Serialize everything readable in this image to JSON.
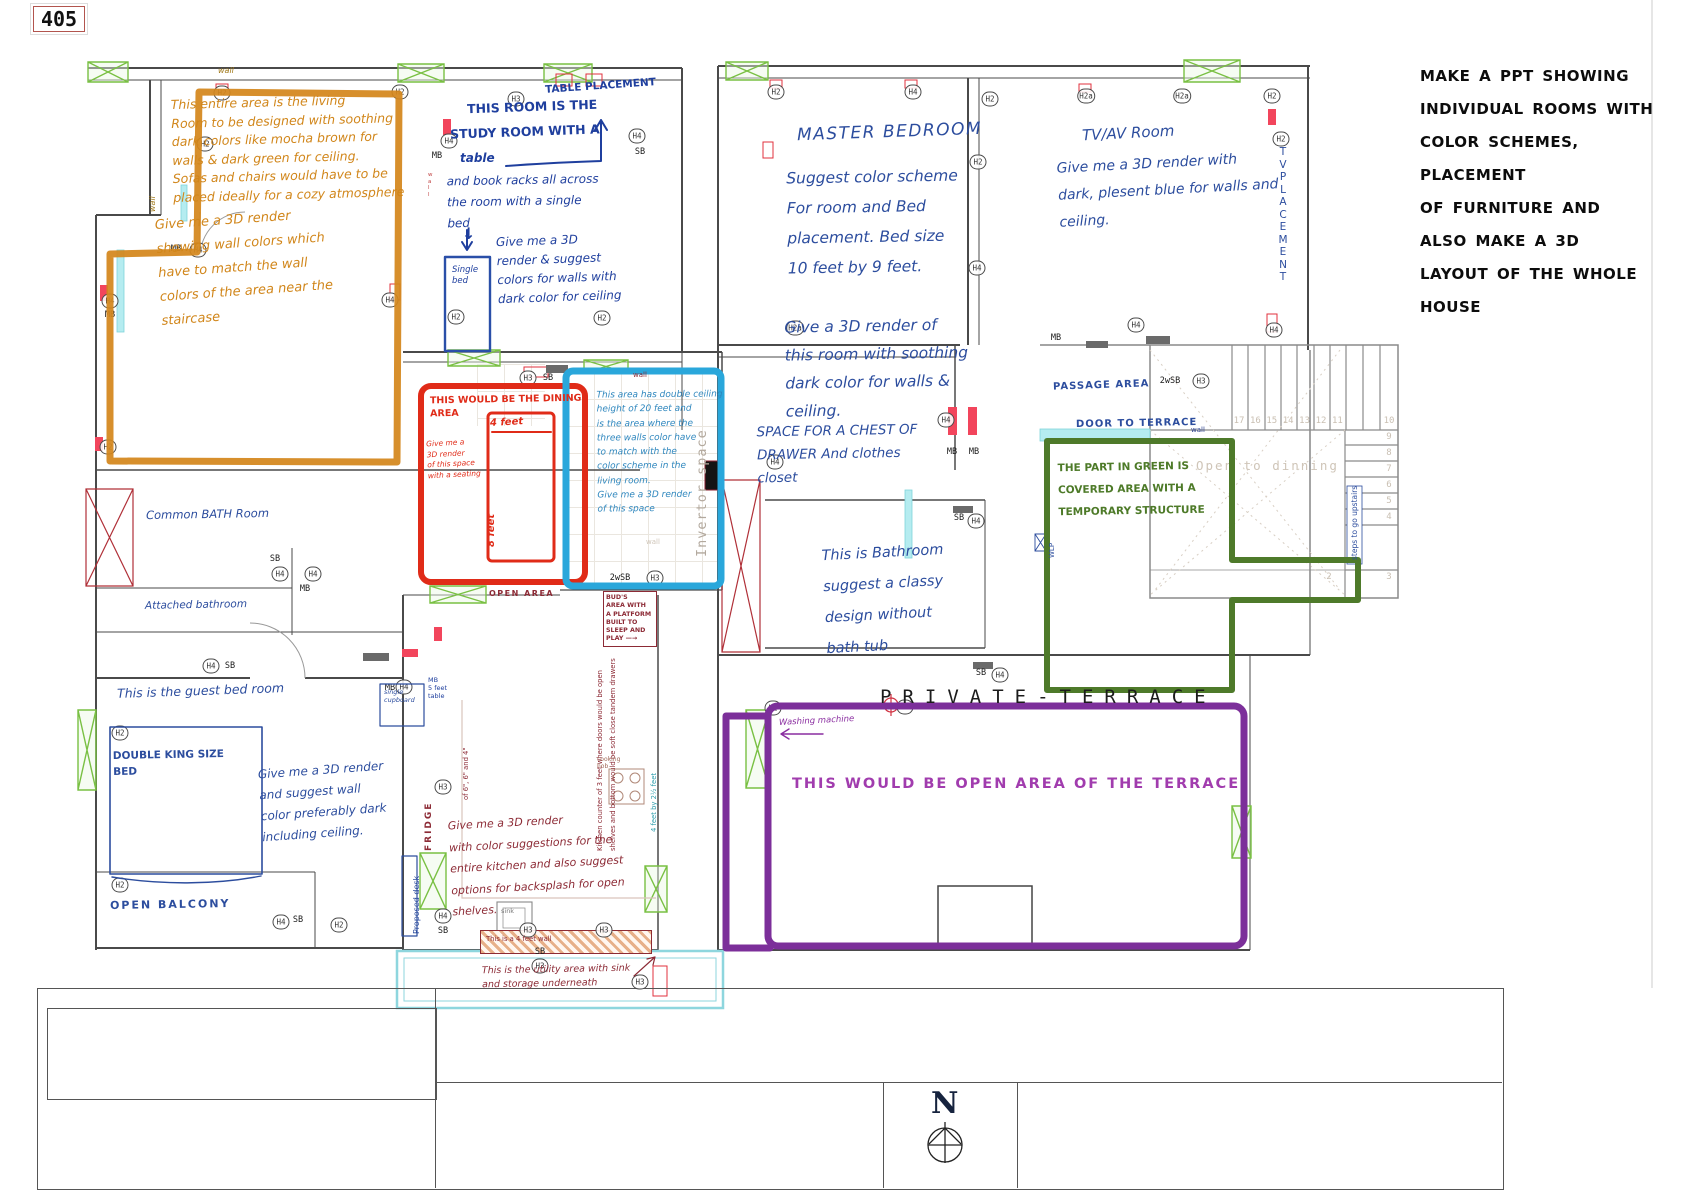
{
  "page": {
    "plan_number": "405",
    "north_label": "N",
    "private_terrace": "PRIVATE-TERRACE"
  },
  "colors": {
    "orange": "#d1861a",
    "blue": "#2c4d9e",
    "red": "#e02b18",
    "cyan": "#2aa7db",
    "green": "#4e7a2a",
    "purple": "#7c2f9a",
    "maroon": "#8c2a35",
    "black": "#0c0c0c"
  },
  "brief": {
    "text": "MAKE A PPT SHOWING\nINDIVIDUAL ROOMS WITH\nCOLOR SCHEMES, PLACEMENT\nOF FURNITURE AND\nALSO MAKE A 3D\nLAYOUT OF THE WHOLE\nHOUSE"
  },
  "living_room": {
    "note": "This entire area is the living\nRoom to be designed with soothing\ndark colors like mocha brown for\nwalls & dark green for ceiling.\nSofas and chairs would have to be\nplaced ideally for a cozy atmosphere",
    "render_note": "Give me a 3D render\nshowing wall colors which\nhave to match the wall\ncolors of the area near the\nstaircase"
  },
  "study_room": {
    "table_placement": "TABLE PLACEMENT",
    "heading1": "THIS ROOM IS THE",
    "heading2": "STUDY ROOM WITH A",
    "heading3": "table",
    "detail": "and book racks all across\nthe room with a single\nbed",
    "arrow_down": "↓",
    "single_bed": "Single\nbed",
    "render_note": "Give me a 3D\nrender & suggest\ncolors for walls with\ndark color for ceiling"
  },
  "dining": {
    "title": "THIS WOULD BE THE DINING\nAREA",
    "render_note": "Give me a\n3D render\nof this space\nwith a seating",
    "width_label": "4 feet",
    "height_label": "8 feet"
  },
  "double_height": {
    "note": "This area has double ceiling\nheight of 20 feet and\nis the area where the\nthree walls color have\nto match with the\ncolor scheme in the\nliving room.\nGive me a 3D render\nof this space",
    "invertor_label": "Invertor space"
  },
  "bath_left": {
    "common": "Common BATH Room",
    "attached": "Attached bathroom",
    "open_area": "OPEN AREA"
  },
  "guest_room": {
    "title": "This is the guest bed room",
    "bed_label": "DOUBLE KING SIZE\nBED",
    "render_note": "Give me a 3D render\nand suggest wall\ncolor preferably dark\nincluding ceiling.",
    "cupboard": "single\ncupboard",
    "side_table": "MB\n5 feet\ntable",
    "desk": "Proposed desk",
    "balcony": "OPEN BALCONY"
  },
  "kitchen": {
    "render_note": "Give me a 3D render\nwith color suggestions for the\nentire kitchen and also suggest\noptions for backsplash for open\nshelves.",
    "buds_note": "BUD'S\nAREA WITH\nA PLATFORM\nBUILT TO\nSLEEP AND\nPLAY —→",
    "counter_note1": "Kitchen counter of 3 feet where doors would be open",
    "counter_note2": "shelves and bottom would be soft close tandem drawers",
    "counter_note3": "of 6\", 6\" and 4\"",
    "counter_dim": "4 feet by 2½ feet",
    "fridge": "FRIDGE",
    "hob": "cooking\nhob",
    "sink": "sink",
    "wall_note": "This is a 4 feet wall",
    "utility_note": "This is the utility area with sink\nand storage underneath"
  },
  "master_bedroom": {
    "title": "MASTER BEDROOM",
    "note1": "Suggest color scheme\nFor room and Bed\nplacement. Bed size\n10 feet by 9 feet.",
    "note2": "Give a 3D render of\nthis room with soothing\ndark color for walls &\nceiling.",
    "note3": "SPACE FOR A CHEST OF\nDRAWER And clothes\ncloset"
  },
  "tv_room": {
    "title": "TV/AV Room",
    "note": "Give me a 3D render with\ndark, plesent blue for walls and\nceiling.",
    "tv_placement": "T\nV\nP\nL\nA\nC\nE\nM\nE\nN\nT"
  },
  "passage": {
    "label": "PASSAGE AREA",
    "door": "DOOR TO TERRACE",
    "wlp": "WLP"
  },
  "covered_area": {
    "note": "THE PART IN GREEN IS\nCOVERED AREA WITH A\nTEMPORARY STRUCTURE"
  },
  "bathroom_right": {
    "note": "This is Bathroom\nsuggest a classy\ndesign without\nbath tub"
  },
  "stairs": {
    "open_label": "Open to dinning",
    "steps_note": "steps to go upstairs",
    "top_numbers": [
      "17",
      "16",
      "15",
      "14",
      "13",
      "12",
      "11"
    ],
    "right_numbers": [
      "10",
      "9",
      "8",
      "7",
      "6",
      "5",
      "4"
    ],
    "bottom_numbers": [
      "2",
      "3"
    ]
  },
  "terrace": {
    "note": "THIS WOULD BE OPEN AREA OF THE TERRACE",
    "washing": "Washing machine"
  },
  "plan_labels": {
    "wall": "wall",
    "wall_vertical": "w\na\nl\nl"
  },
  "markers": [
    {
      "label": "H2",
      "x": 222,
      "y": 93,
      "circled": true
    },
    {
      "label": "H2",
      "x": 400,
      "y": 92,
      "circled": true
    },
    {
      "label": "H3",
      "x": 516,
      "y": 99,
      "circled": true
    },
    {
      "label": "H4",
      "x": 637,
      "y": 136,
      "circled": true
    },
    {
      "label": "SB",
      "x": 640,
      "y": 152,
      "circled": false
    },
    {
      "label": "H4",
      "x": 449,
      "y": 141,
      "circled": true
    },
    {
      "label": "MB",
      "x": 437,
      "y": 156,
      "circled": false
    },
    {
      "label": "H2",
      "x": 205,
      "y": 144,
      "circled": true
    },
    {
      "label": "MB",
      "x": 176,
      "y": 249,
      "circled": false
    },
    {
      "label": "H4",
      "x": 198,
      "y": 250,
      "circled": true
    },
    {
      "label": "H4",
      "x": 110,
      "y": 301,
      "circled": true
    },
    {
      "label": "MB",
      "x": 110,
      "y": 315,
      "circled": false
    },
    {
      "label": "H4",
      "x": 390,
      "y": 300,
      "circled": true
    },
    {
      "label": "H2",
      "x": 456,
      "y": 317,
      "circled": true
    },
    {
      "label": "H2",
      "x": 602,
      "y": 318,
      "circled": true
    },
    {
      "label": "H2",
      "x": 108,
      "y": 447,
      "circled": true
    },
    {
      "label": "H3",
      "x": 528,
      "y": 378,
      "circled": true
    },
    {
      "label": "SB",
      "x": 548,
      "y": 378,
      "circled": false
    },
    {
      "label": "SB",
      "x": 275,
      "y": 559,
      "circled": false
    },
    {
      "label": "H4",
      "x": 280,
      "y": 574,
      "circled": true
    },
    {
      "label": "H4",
      "x": 313,
      "y": 574,
      "circled": true
    },
    {
      "label": "MB",
      "x": 305,
      "y": 589,
      "circled": false
    },
    {
      "label": "2wSB",
      "x": 620,
      "y": 578,
      "circled": false
    },
    {
      "label": "H3",
      "x": 655,
      "y": 578,
      "circled": true
    },
    {
      "label": "H4",
      "x": 211,
      "y": 666,
      "circled": true
    },
    {
      "label": "SB",
      "x": 230,
      "y": 666,
      "circled": false
    },
    {
      "label": "H2",
      "x": 120,
      "y": 733,
      "circled": true
    },
    {
      "label": "H2",
      "x": 120,
      "y": 885,
      "circled": true
    },
    {
      "label": "H4",
      "x": 404,
      "y": 687,
      "circled": true
    },
    {
      "label": "MB",
      "x": 390,
      "y": 688,
      "circled": false
    },
    {
      "label": "H3",
      "x": 443,
      "y": 787,
      "circled": true
    },
    {
      "label": "H4",
      "x": 443,
      "y": 916,
      "circled": true
    },
    {
      "label": "SB",
      "x": 443,
      "y": 931,
      "circled": false
    },
    {
      "label": "SB",
      "x": 540,
      "y": 952,
      "circled": false
    },
    {
      "label": "H3",
      "x": 540,
      "y": 966,
      "circled": true
    },
    {
      "label": "H3",
      "x": 528,
      "y": 930,
      "circled": true
    },
    {
      "label": "H3",
      "x": 604,
      "y": 930,
      "circled": true
    },
    {
      "label": "H3",
      "x": 640,
      "y": 982,
      "circled": true
    },
    {
      "label": "H4",
      "x": 281,
      "y": 922,
      "circled": true
    },
    {
      "label": "SB",
      "x": 298,
      "y": 920,
      "circled": false
    },
    {
      "label": "H2",
      "x": 339,
      "y": 925,
      "circled": true
    },
    {
      "label": "H2",
      "x": 776,
      "y": 92,
      "circled": true
    },
    {
      "label": "H4",
      "x": 913,
      "y": 92,
      "circled": true
    },
    {
      "label": "H2",
      "x": 990,
      "y": 99,
      "circled": true
    },
    {
      "label": "H2a",
      "x": 1086,
      "y": 96,
      "circled": true
    },
    {
      "label": "H2a",
      "x": 1182,
      "y": 96,
      "circled": true
    },
    {
      "label": "H2",
      "x": 1272,
      "y": 96,
      "circled": true
    },
    {
      "label": "H2",
      "x": 1281,
      "y": 139,
      "circled": true
    },
    {
      "label": "H2",
      "x": 978,
      "y": 162,
      "circled": true
    },
    {
      "label": "H2a",
      "x": 795,
      "y": 328,
      "circled": true
    },
    {
      "label": "H4",
      "x": 977,
      "y": 268,
      "circled": true
    },
    {
      "label": "H4",
      "x": 946,
      "y": 420,
      "circled": true
    },
    {
      "label": "MB",
      "x": 952,
      "y": 452,
      "circled": false
    },
    {
      "label": "MB",
      "x": 974,
      "y": 452,
      "circled": false
    },
    {
      "label": "H4",
      "x": 775,
      "y": 462,
      "circled": true
    },
    {
      "label": "MB",
      "x": 1056,
      "y": 338,
      "circled": false
    },
    {
      "label": "H4",
      "x": 1136,
      "y": 325,
      "circled": true
    },
    {
      "label": "2wSB",
      "x": 1170,
      "y": 381,
      "circled": false
    },
    {
      "label": "H3",
      "x": 1201,
      "y": 381,
      "circled": true
    },
    {
      "label": "SB",
      "x": 959,
      "y": 518,
      "circled": false
    },
    {
      "label": "H4",
      "x": 976,
      "y": 521,
      "circled": true
    },
    {
      "label": "SB",
      "x": 981,
      "y": 673,
      "circled": false
    },
    {
      "label": "H4",
      "x": 1000,
      "y": 675,
      "circled": true
    },
    {
      "label": "H5",
      "x": 905,
      "y": 707,
      "circled": true
    },
    {
      "label": "H2",
      "x": 773,
      "y": 708,
      "circled": true
    },
    {
      "label": "H4",
      "x": 1274,
      "y": 330,
      "circled": true
    }
  ]
}
